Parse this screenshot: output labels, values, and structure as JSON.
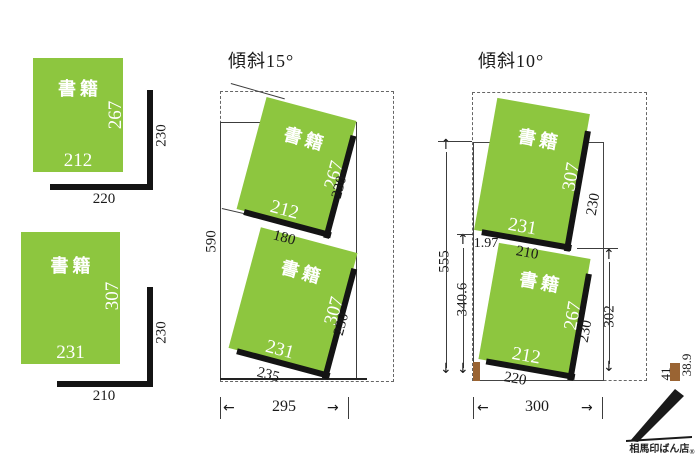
{
  "colors": {
    "book_green": "#8dc63f",
    "bracket_black": "#141414",
    "brown_accent": "#9a6433"
  },
  "glyphs": {
    "up": "↑",
    "down": "↓",
    "left": "←",
    "right": "→"
  },
  "left": {
    "top_book": {
      "name": "書籍",
      "spine": "267",
      "width": "212"
    },
    "top_bracket": {
      "height": "230",
      "width": "220"
    },
    "bottom_book": {
      "name": "書籍",
      "spine": "307",
      "width": "231"
    },
    "bottom_bracket": {
      "height": "230",
      "width": "210"
    }
  },
  "tilt15": {
    "title": "傾斜15°",
    "case_height": "590",
    "case_width": "295",
    "top_book": {
      "name": "書籍",
      "spine": "267",
      "width": "212",
      "bracket": "230"
    },
    "shelf_gap": "180",
    "bottom_book": {
      "name": "書籍",
      "spine": "307",
      "width": "231",
      "bracket": "230"
    },
    "base_width": "235"
  },
  "tilt10": {
    "title": "傾斜10°",
    "case_height": "555",
    "lower_height": "340.6",
    "top_offset": "1.97",
    "shelf_gap": "210",
    "book_zone_height": "302",
    "case_width": "300",
    "base_width": "220",
    "top_book": {
      "name": "書籍",
      "spine": "307",
      "width": "231",
      "bracket": "230"
    },
    "bottom_book": {
      "name": "書籍",
      "spine": "267",
      "width": "212",
      "bracket": "230"
    }
  },
  "legend": {
    "dim_a": "41",
    "dim_b": "38.9"
  },
  "logo": {
    "name": "相馬印ばん店",
    "mark": "®"
  }
}
